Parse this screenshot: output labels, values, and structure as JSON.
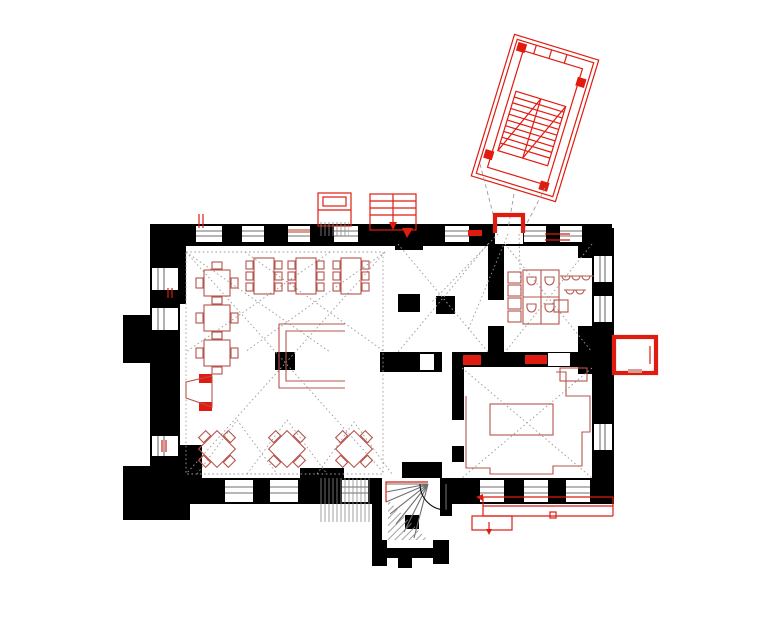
{
  "drawing": {
    "type": "architectural-floor-plan",
    "style": "existing walls in black poche, new construction and furniture in red, vault projections as dotted lines"
  },
  "canvas": {
    "width": 780,
    "height": 624,
    "background": "#ffffff"
  },
  "palette": {
    "wall_black": "#000000",
    "new_construction_red": "#e01b10",
    "furniture_red": "#b5544c",
    "vault_line_gray": "#9b9b9b",
    "hatch_gray": "#8a8a8a",
    "window_line_gray": "#6e6e6e",
    "sill_pink": "#d89c94"
  },
  "furniture": {
    "square_tables": [
      {
        "x": 217,
        "y": 283
      },
      {
        "x": 217,
        "y": 318
      },
      {
        "x": 217,
        "y": 353
      }
    ],
    "rect_tables": [
      {
        "x": 264,
        "y": 276
      },
      {
        "x": 306,
        "y": 276
      },
      {
        "x": 351,
        "y": 276
      }
    ],
    "diamond_tables": [
      {
        "x": 217,
        "y": 449
      },
      {
        "x": 287,
        "y": 449
      },
      {
        "x": 354,
        "y": 449
      }
    ]
  }
}
